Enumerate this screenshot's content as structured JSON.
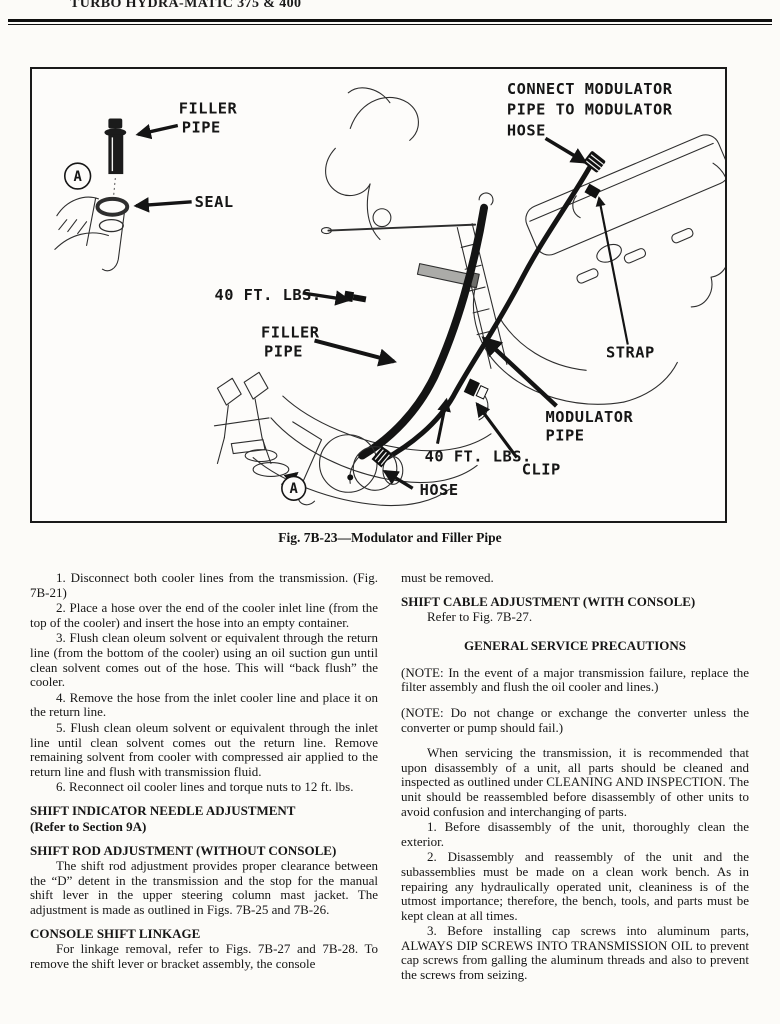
{
  "header": {
    "title": "TURBO HYDRA-MATIC 375 & 400"
  },
  "figure": {
    "caption": "Fig. 7B-23—Modulator and Filler Pipe",
    "labels": {
      "filler_pipe_top": [
        "FILLER",
        "PIPE"
      ],
      "seal": "SEAL",
      "connect_modulator": [
        "CONNECT MODULATOR",
        "PIPE TO MODULATOR",
        "HOSE"
      ],
      "torque_40_left": "40 FT. LBS.",
      "filler_pipe_mid": [
        "FILLER",
        "PIPE"
      ],
      "strap": "STRAP",
      "modulator_pipe": [
        "MODULATOR",
        "PIPE"
      ],
      "torque_40_right": "40 FT. LBS.",
      "clip": "CLIP",
      "hose": "HOSE",
      "detail_marker": "A"
    }
  },
  "left_column": {
    "steps": [
      "1. Disconnect both cooler lines from the transmission. (Fig. 7B-21)",
      "2. Place a hose over the end of the cooler inlet line (from the top of the cooler) and insert the hose into an empty container.",
      "3. Flush clean oleum solvent or equivalent through the return line (from the bottom of the cooler) using an oil suction gun until clean solvent comes out of the hose. This will “back flush” the cooler.",
      "4. Remove the hose from the inlet cooler line and place it on the return line.",
      "5. Flush clean oleum solvent or equivalent through the inlet line until clean solvent comes out the return line. Remove remaining solvent from cooler with compressed air applied to the return line and flush with transmission fluid.",
      "6. Reconnect oil cooler lines and torque nuts to 12 ft. lbs."
    ],
    "heading_shift_indicator": "SHIFT INDICATOR NEEDLE ADJUSTMENT",
    "heading_shift_indicator_sub": "(Refer to Section 9A)",
    "heading_shift_rod": "SHIFT ROD ADJUSTMENT (WITHOUT CONSOLE)",
    "shift_rod_body": "The shift rod adjustment provides proper clearance between the “D” detent in the transmission and the stop for the manual shift lever in the upper steering column mast jacket. The adjustment is made as outlined in Figs. 7B-25 and 7B-26.",
    "heading_console": "CONSOLE SHIFT LINKAGE",
    "console_body": "For linkage removal, refer to Figs. 7B-27 and 7B-28. To remove the shift lever or bracket assembly, the console"
  },
  "right_column": {
    "continuation": "must be removed.",
    "heading_shift_cable": "SHIFT CABLE ADJUSTMENT (WITH CONSOLE)",
    "shift_cable_body": "Refer to Fig. 7B-27.",
    "heading_general": "GENERAL SERVICE PRECAUTIONS",
    "note1": "(NOTE: In the event of a major transmission failure, replace the filter assembly and flush the oil cooler and lines.)",
    "note2": "(NOTE: Do not change or exchange the converter unless the converter or pump should fail.)",
    "para_servicing": "When servicing the transmission, it is recommended that upon disassembly of a unit, all parts should be cleaned and inspected as outlined under CLEANING AND INSPECTION. The unit should be reassembled before disassembly of other units to avoid confusion and interchanging of parts.",
    "items": [
      "1. Before disassembly of the unit, thoroughly clean the exterior.",
      "2. Disassembly and reassembly of the unit and the subassemblies must be made on a clean work bench. As in repairing any hydraulically operated unit, cleaniness is of the utmost importance; therefore, the bench, tools, and parts must be kept clean at all times.",
      "3. Before installing cap screws into aluminum parts, ALWAYS DIP SCREWS INTO TRANSMISSION OIL to prevent cap screws from galling the aluminum threads and also to prevent the screws from seizing."
    ]
  }
}
